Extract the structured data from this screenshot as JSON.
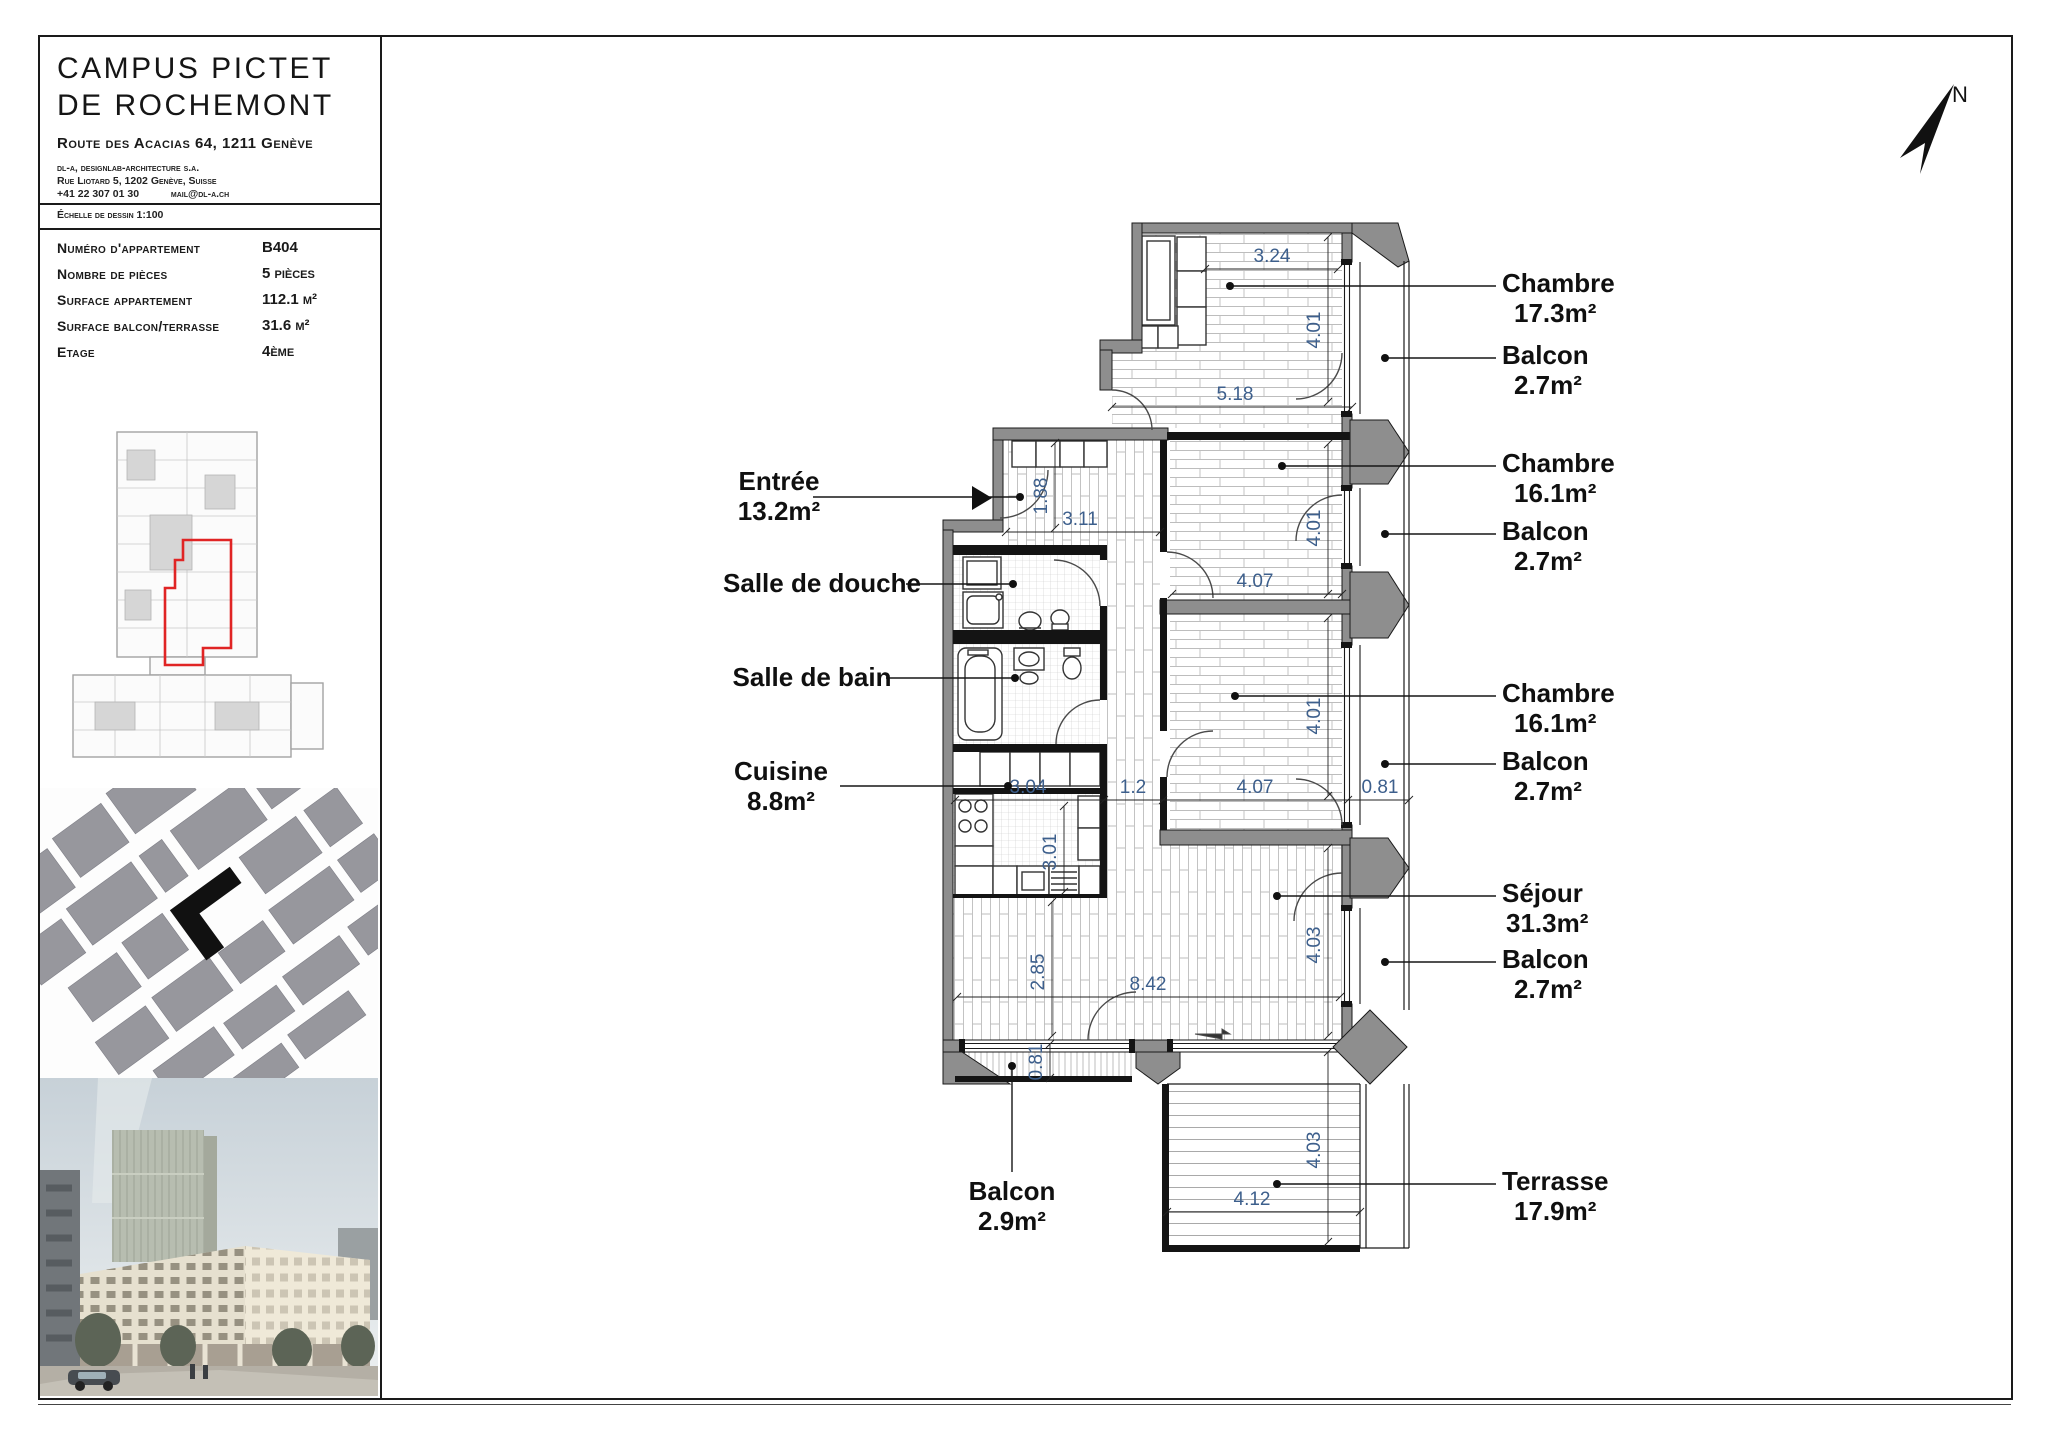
{
  "sheet": {
    "title_line1": "CAMPUS PICTET",
    "title_line2": "DE ROCHEMONT",
    "address": "Route des Acacias 64, 1211 Genève",
    "firm_line1": "dl-a, designlab-architecture s.a.",
    "firm_line2": "Rue Liotard 5, 1202 Genève, Suisse",
    "firm_phone": "+41 22 307 01 30",
    "firm_email": "mail@dl-a.ch",
    "scale_label": "Échelle de dessin 1:100"
  },
  "info": {
    "rows": [
      {
        "label": "Numéro d'appartement",
        "value": "B404"
      },
      {
        "label": "Nombre de pièces",
        "value": "5 pièces"
      },
      {
        "label": "Surface appartement",
        "value": "112.1 m²"
      },
      {
        "label": "Surface balcon/terrasse",
        "value": "31.6 m²"
      },
      {
        "label": "Etage",
        "value": "4ème"
      }
    ]
  },
  "compass": {
    "label": "N"
  },
  "rooms": {
    "left": [
      {
        "name": "Entrée",
        "area": "13.2m²"
      },
      {
        "name": "Salle de douche",
        "area": ""
      },
      {
        "name": "Salle de bain",
        "area": ""
      },
      {
        "name": "Cuisine",
        "area": "8.8m²"
      },
      {
        "name": "Balcon",
        "area": "2.9m²"
      }
    ],
    "right": [
      {
        "name": "Chambre",
        "area": "17.3m²"
      },
      {
        "name": "Balcon",
        "area": "2.7m²"
      },
      {
        "name": "Chambre",
        "area": "16.1m²"
      },
      {
        "name": "Balcon",
        "area": "2.7m²"
      },
      {
        "name": "Chambre",
        "area": "16.1m²"
      },
      {
        "name": "Balcon",
        "area": "2.7m²"
      },
      {
        "name": "Séjour",
        "area": "31.3m²"
      },
      {
        "name": "Balcon",
        "area": "2.7m²"
      },
      {
        "name": "Terrasse",
        "area": "17.9m²"
      }
    ]
  },
  "dims": {
    "d_324": "3.24",
    "d_401a": "4.01",
    "d_518": "5.18",
    "d_188": "1.88",
    "d_311": "3.11",
    "d_401b": "4.01",
    "d_407a": "4.07",
    "d_401c": "4.01",
    "d_304": "3.04",
    "d_12": "1.2",
    "d_407b": "4.07",
    "d_081a": "0.81",
    "d_301": "3.01",
    "d_285": "2.85",
    "d_842": "8.42",
    "d_403a": "4.03",
    "d_081b": "0.81",
    "d_403b": "4.03",
    "d_412": "4.12"
  }
}
